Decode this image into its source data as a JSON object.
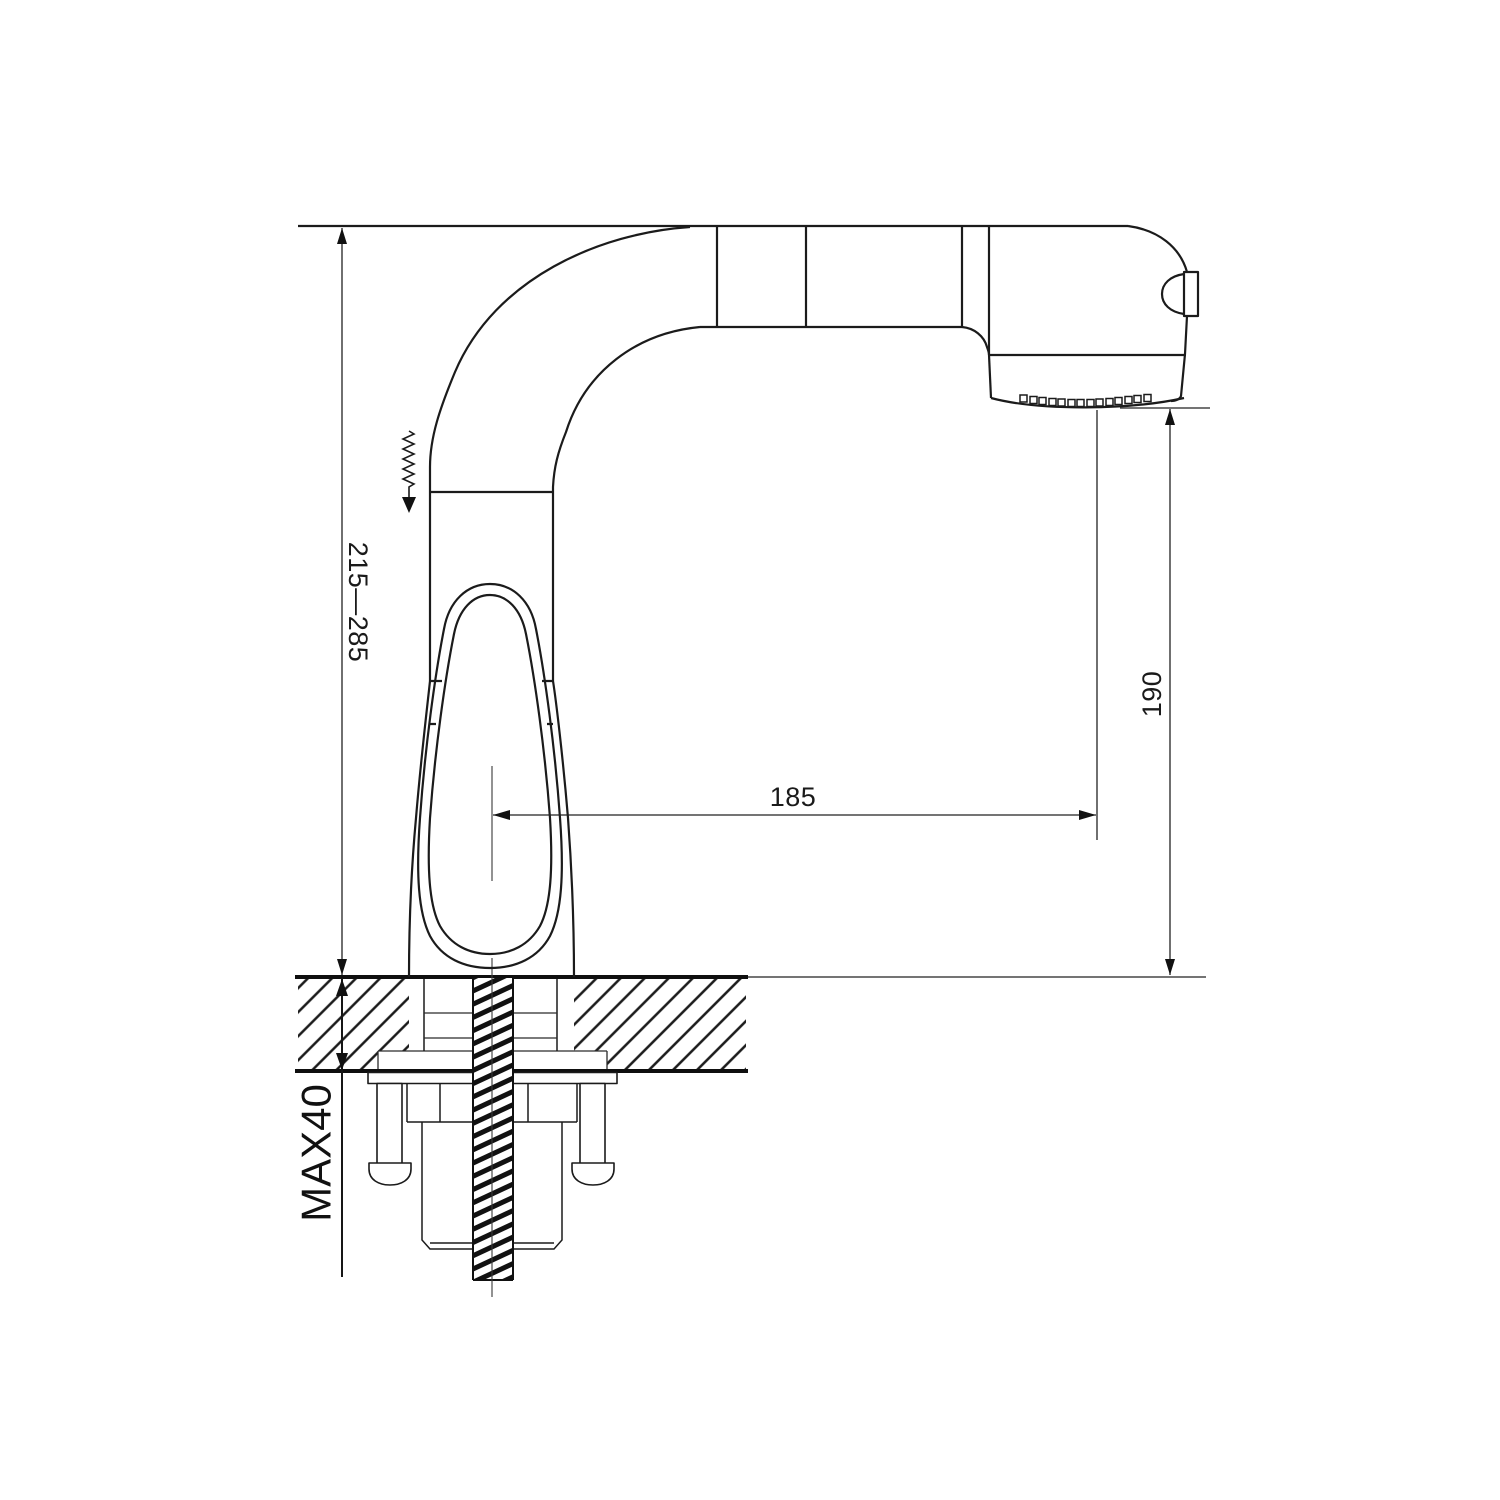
{
  "drawing": {
    "background": "#ffffff",
    "line_color": "#1b1b1b",
    "labels": {
      "height_range": "215—285",
      "spout_height": "190",
      "reach": "185",
      "max_counter_thickness": "MAX40"
    }
  }
}
